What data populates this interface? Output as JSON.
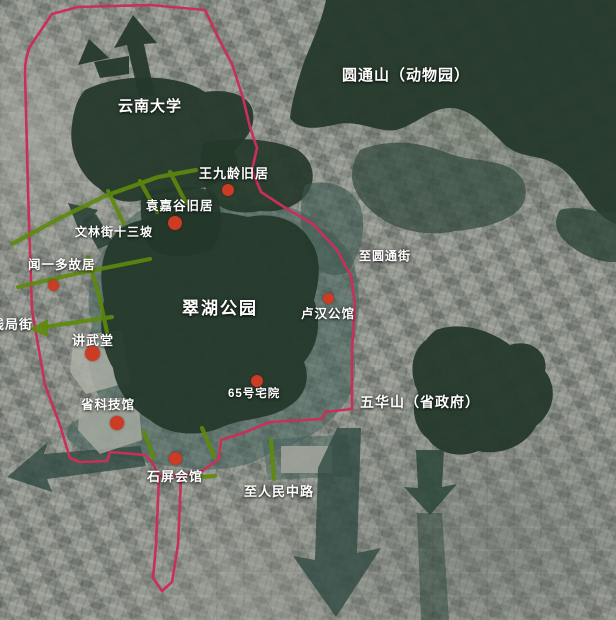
{
  "map": {
    "region_labels": [
      {
        "id": "yunnan-university",
        "text": "云南大学"
      },
      {
        "id": "yuantongshan-zoo",
        "text": "圆通山（动物园）"
      },
      {
        "id": "cuihu-park",
        "text": "翠湖公园"
      },
      {
        "id": "wuhuashan-gov",
        "text": "五华山（省政府）"
      }
    ],
    "poi": [
      {
        "id": "wangjiuling",
        "name": "王九龄旧居"
      },
      {
        "id": "yuanjiagu",
        "name": "袁嘉谷旧居"
      },
      {
        "id": "wenyiduo",
        "name": "闻一多故居"
      },
      {
        "id": "jiangwutang",
        "name": "讲武堂"
      },
      {
        "id": "science-museum",
        "name": "省科技馆"
      },
      {
        "id": "no65-residence",
        "name": "65号宅院"
      },
      {
        "id": "luhan-mansion",
        "name": "卢汉公馆"
      },
      {
        "id": "shiping-hall",
        "name": "石屏会馆"
      }
    ],
    "street_labels": [
      {
        "id": "wenlin-street",
        "text": "文林街十三坡"
      },
      {
        "id": "qianju-street",
        "text": "钱局街"
      },
      {
        "id": "to-yuantong-street",
        "text": "至圆通街"
      },
      {
        "id": "to-renmin-road",
        "text": "至人民中路"
      }
    ],
    "colors": {
      "route": "#c93058",
      "street_green": "#5e8a0c",
      "marker_red": "#cc3b24",
      "area_dark_green": "#25392b",
      "area_teal": "#41605a",
      "label_white": "#ffffff"
    }
  }
}
